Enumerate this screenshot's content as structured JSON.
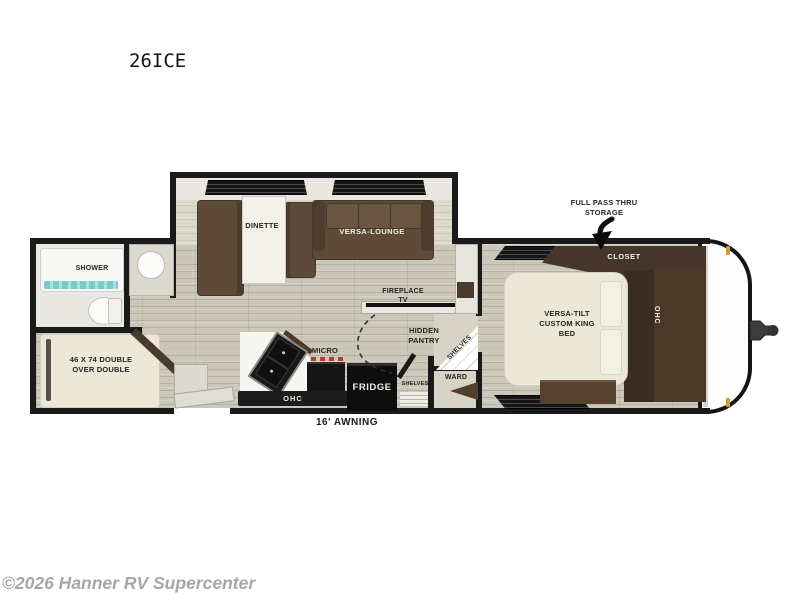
{
  "title": "26ICE",
  "footer": {
    "copyright": "©2026 Hanner RV Supercenter"
  },
  "floorplan": {
    "slideout": {
      "dinette": "DINETTE",
      "versa_lounge": "VERSA-LOUNGE"
    },
    "bathroom": {
      "shower": "SHOWER"
    },
    "bunkroom": {
      "bunk_bed": "46 X 74 DOUBLE OVER DOUBLE"
    },
    "kitchen": {
      "micro": "MICRO",
      "fridge": "FRIDGE",
      "ohc": "OHC",
      "fireplace_tv": "FIREPLACE TV",
      "hidden_pantry": "HIDDEN PANTRY"
    },
    "storage": {
      "shelves_corner": "SHELVES",
      "shelves_lower": "SHELVES",
      "ward": "WARD"
    },
    "bedroom": {
      "king_bed": "VERSA-TILT CUSTOM KING BED",
      "closet": "CLOSET",
      "ohc": "OHC"
    },
    "annotations": {
      "pass_thru": "FULL PASS THRU STORAGE",
      "awning": "16' AWNING"
    }
  },
  "colors": {
    "wall": "#1a1a1a",
    "floor_wood": "#cbc7b9",
    "sofa_brown": "#5d4a39",
    "cabinet_dark_brown": "#46352a",
    "bed_cream": "#ece8d8",
    "water_teal": "#86d0cd",
    "burner_red": "#c0392b",
    "marker_amber": "#d79b2a",
    "copyright_gray": "#a6a6a6"
  }
}
